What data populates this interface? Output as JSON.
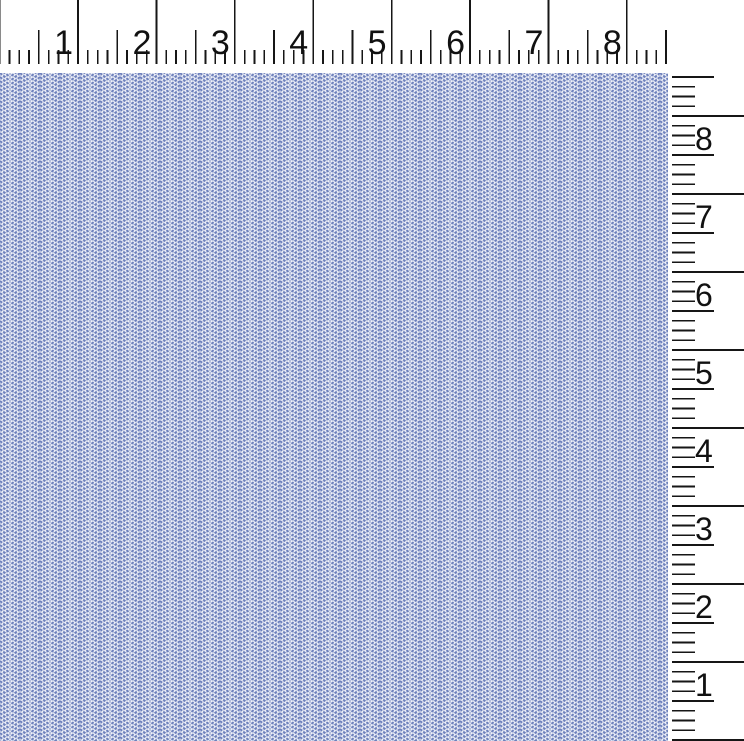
{
  "image": {
    "kind": "fabric-swatch-scan",
    "width_px": 744,
    "height_px": 741
  },
  "colors": {
    "ruler_background": "#ffffff",
    "tick": "#161616",
    "ruler_number": "#111111",
    "fabric_base": "#eff1f8",
    "fabric_blue": "#6d80bc",
    "fabric_blue_light": "#bac4e1"
  },
  "top_ruler": {
    "orientation": "horizontal",
    "unit": "inch",
    "numbers": [
      "1",
      "2",
      "3",
      "4",
      "5",
      "6",
      "7",
      "8"
    ],
    "divisions_per_unit": 8,
    "px_per_unit": 78.4,
    "origin_px": -0.4,
    "length_px": 668,
    "height_px": 73,
    "tick_bottom_px": 64,
    "tick_top_integer_px": 0,
    "tick_top_half_px": 30,
    "tick_top_eighth_px": 50,
    "number_top_px": 26,
    "number_gap_px": 5
  },
  "right_ruler": {
    "orientation": "vertical",
    "unit": "inch",
    "numbers": [
      "8",
      "7",
      "6",
      "5",
      "4",
      "3",
      "2",
      "1"
    ],
    "divisions_per_unit": 8,
    "px_per_unit": 78,
    "origin_bottom_px": 740,
    "span_top_px": 73,
    "width_px": 76,
    "tick_left_px": 4,
    "tick_end_eighth_px": 27,
    "tick_end_half_px": 46,
    "tick_end_integer_px": 76,
    "number_left_px": 27,
    "number_offset_px": 7
  },
  "fabric": {
    "pattern": "herringbone-weave",
    "chevron_column_width_px": 20,
    "weave_repeat_height_px": 8,
    "left_px": 0,
    "top_px": 73,
    "width_px": 668,
    "height_px": 668
  }
}
